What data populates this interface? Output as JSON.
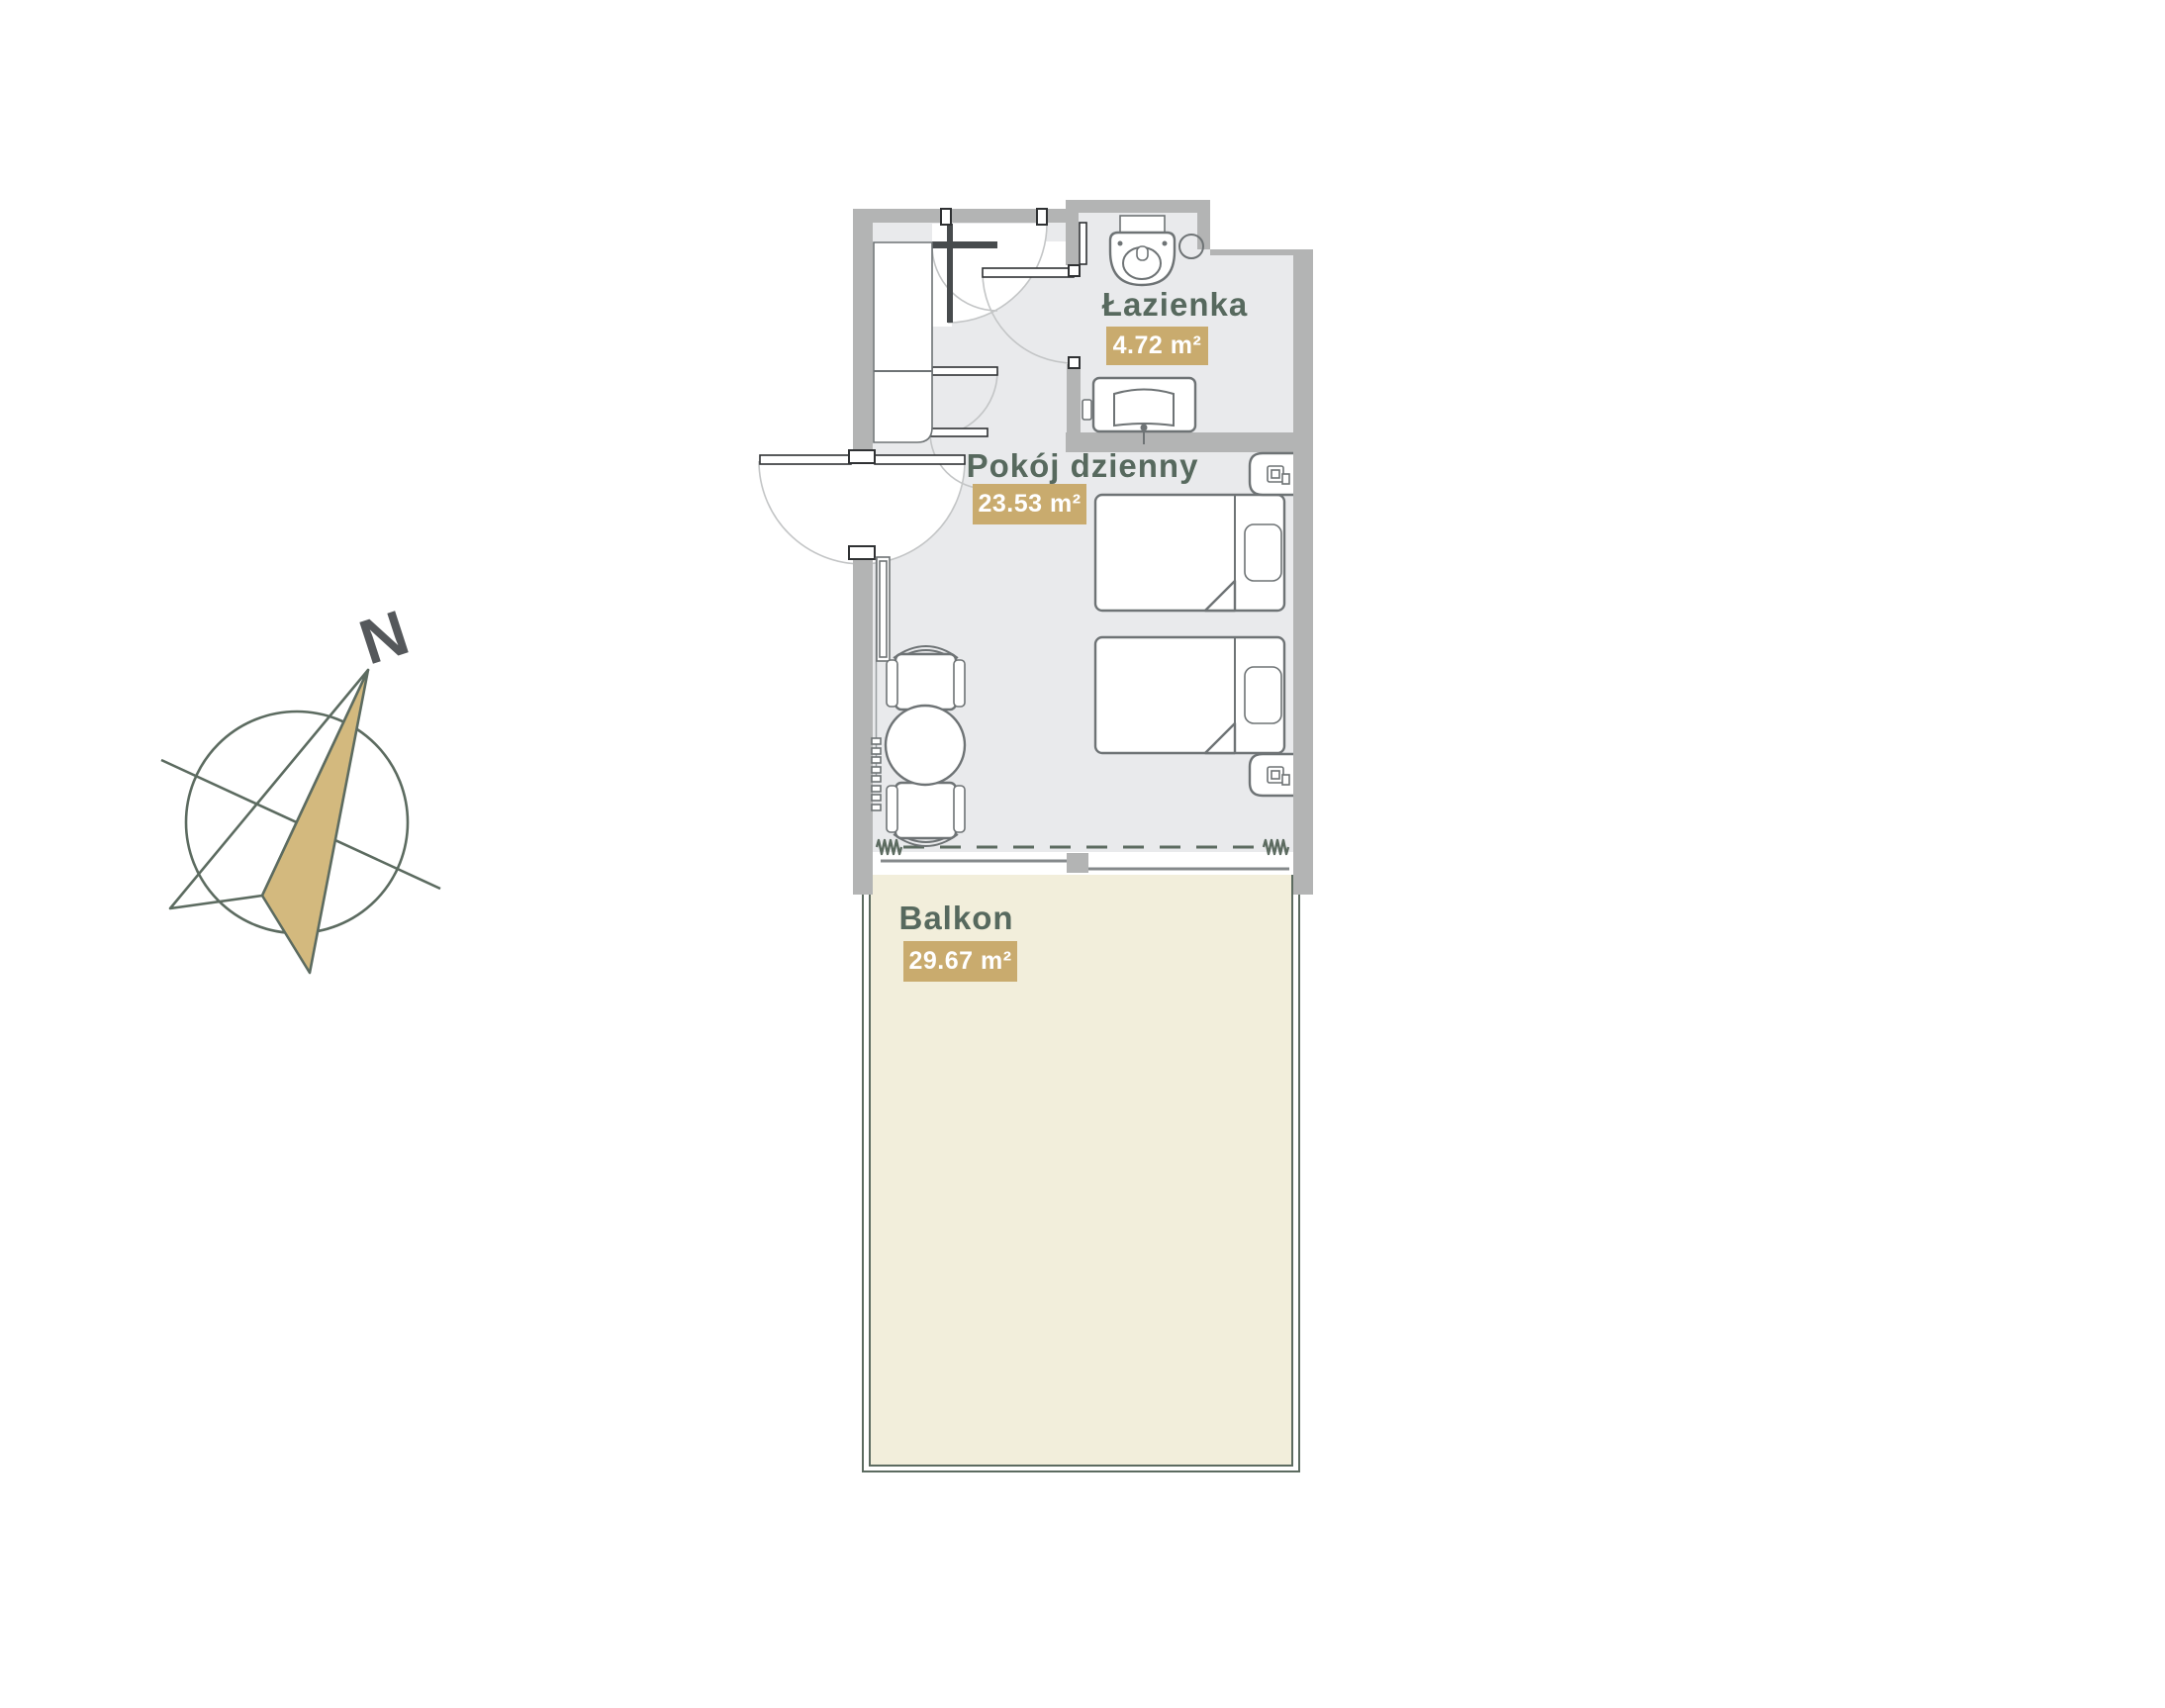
{
  "plan": {
    "rooms": [
      {
        "id": "lazienka",
        "name": "Łazienka",
        "area": "4.72 m²"
      },
      {
        "id": "pokoj_dzienny",
        "name": "Pokój dzienny",
        "area": "23.53 m²"
      },
      {
        "id": "balkon",
        "name": "Balkon",
        "area": "29.67 m²"
      }
    ],
    "compass": {
      "north_label": "N"
    },
    "colors": {
      "wall": "#b3b4b4",
      "floor": "#e9eaec",
      "balcony_floor": "#f2eedb",
      "area_badge": "#c9ab6e",
      "room_label": "#57695e",
      "plan_outline": "#5c6b60",
      "furniture_outline": "#6e7375",
      "needle_fill": "#d3b97e"
    }
  }
}
